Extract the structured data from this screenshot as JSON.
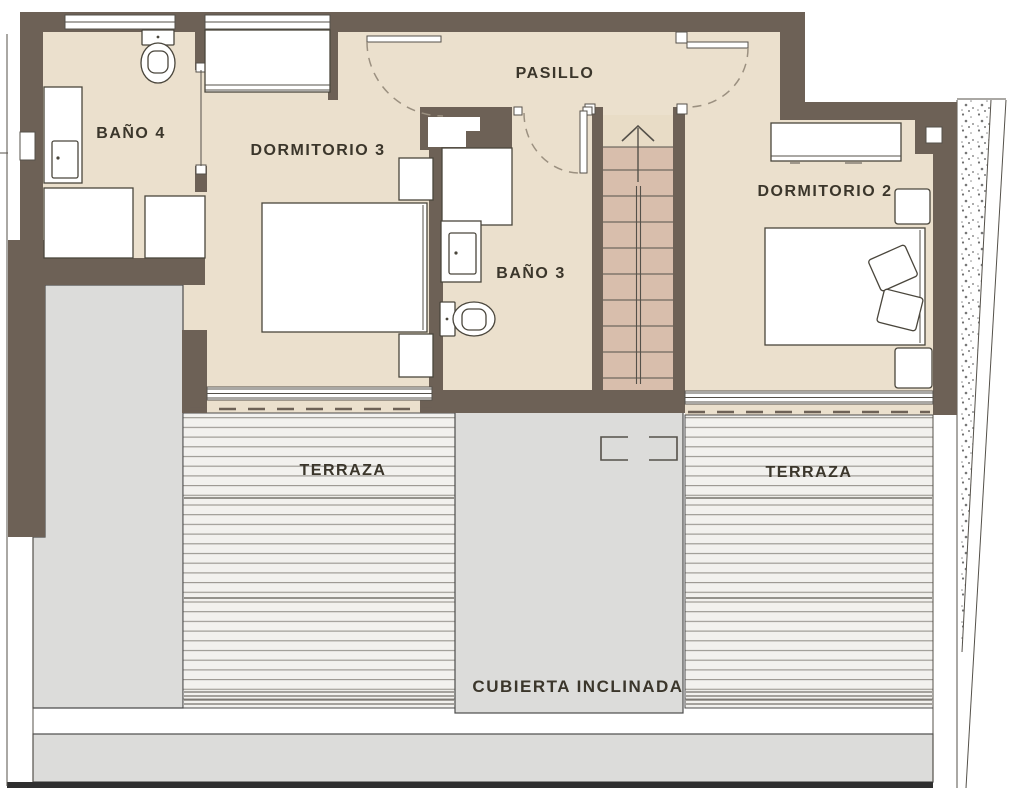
{
  "title": "Floor plan - upper level",
  "palette": {
    "wall": "#6d6156",
    "floor": "#ebe0cd",
    "tread": "#d8beac",
    "treadTop": "#e8dcc6",
    "deckBg": "#f2f1ee",
    "deckLine": "#97948e",
    "gray": "#dcdcda",
    "grayStroke": "#4c4c4c",
    "furnStroke": "#4a463c",
    "thin": "#55514a",
    "dash": "#9b9080",
    "text": "#3b362b"
  },
  "rooms": {
    "pasillo": {
      "label": "PASILLO"
    },
    "bano4": {
      "label": "BAÑO 4"
    },
    "dormitorio3": {
      "label": "DORMITORIO 3"
    },
    "bano3": {
      "label": "BAÑO 3"
    },
    "dormitorio2": {
      "label": "DORMITORIO 2"
    },
    "terraza_left": {
      "label": "TERRAZA"
    },
    "terraza_right": {
      "label": "TERRAZA"
    },
    "cubierta": {
      "label": "CUBIERTA INCLINADA"
    }
  }
}
